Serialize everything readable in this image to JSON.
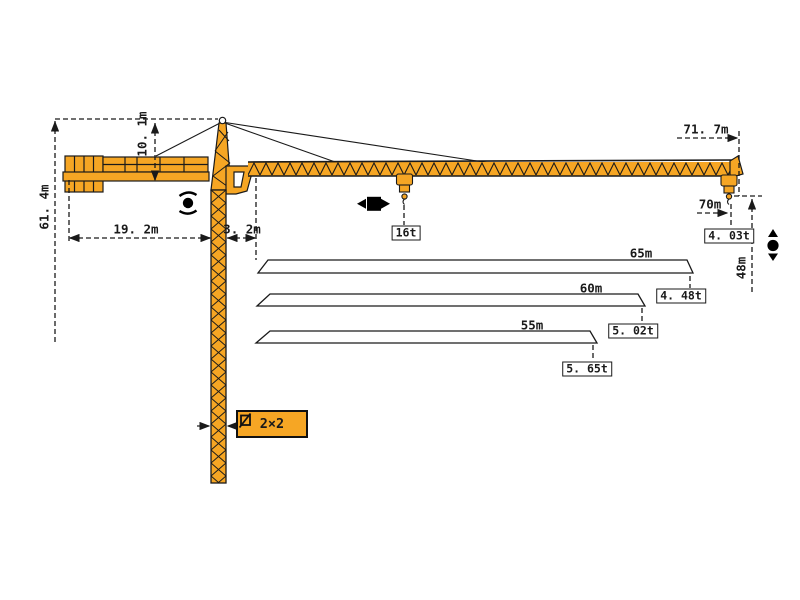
{
  "diagram_title": "tower-crane-working-range-diagram",
  "dimensions": {
    "total_height": "61. 4m",
    "tower_head_height": "10. 1m",
    "counter_jib_length": "19. 2m",
    "jib_root_offset": "3. 2m",
    "max_working_radius": "71. 7m",
    "radius_at_tip": "70m",
    "hook_height": "48m"
  },
  "loads": {
    "max_load": "16t",
    "tip_load_at_70m": "4. 03t"
  },
  "mast": {
    "section_size": "2×2"
  },
  "jib_variants": [
    {
      "length": "65m",
      "tip_load": "4. 48t"
    },
    {
      "length": "60m",
      "tip_load": "5. 02t"
    },
    {
      "length": "55m",
      "tip_load": "5. 65t"
    }
  ],
  "icons": {
    "slewing": "slewing-rotation-icon",
    "trolley": "trolley-travel-icon",
    "hoist": "hoist-up-down-icon",
    "mast_section_symbol": "square-section-icon"
  },
  "colors": {
    "crane": "#F6A624",
    "outline": "#1A1A1A",
    "background": "#FFFFFF"
  }
}
